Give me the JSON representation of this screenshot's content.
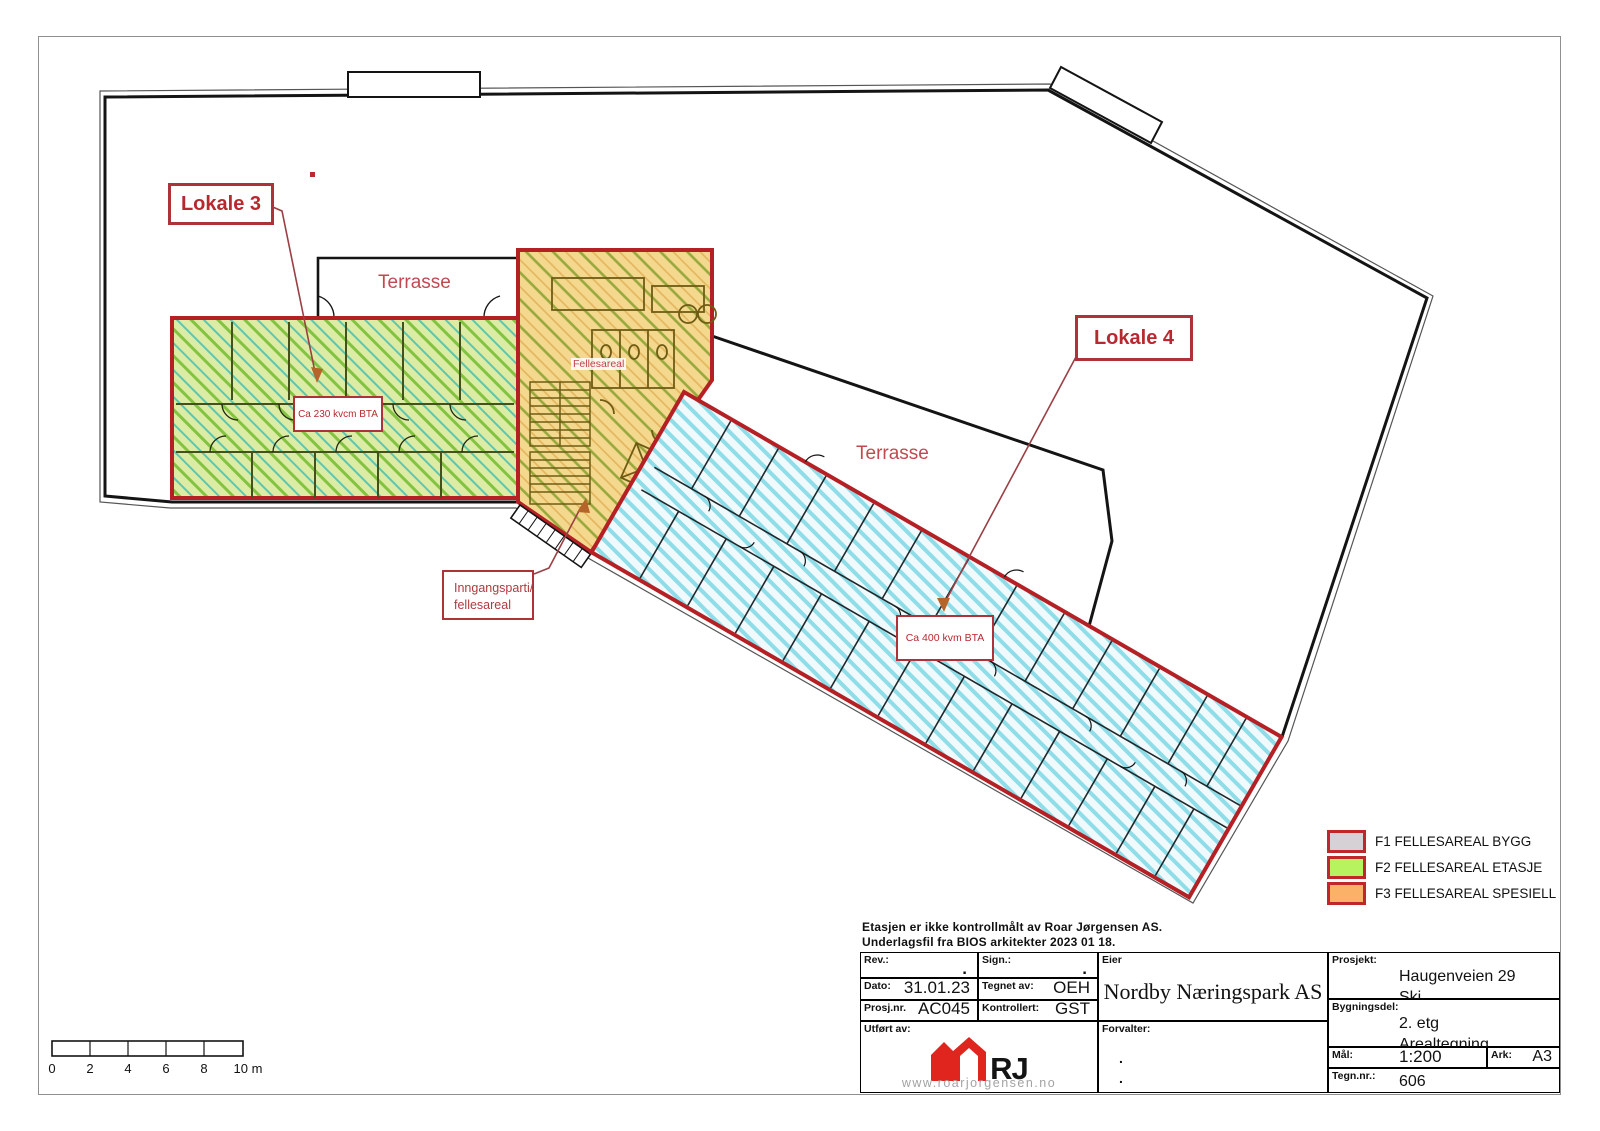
{
  "plan": {
    "lokale3": "Lokale 3",
    "lokale4": "Lokale 4",
    "terrasse_left": "Terrasse",
    "terrasse_right": "Terrasse",
    "fellesareal": "Fellesareal",
    "inngangsparti_line1": "Inngangsparti/",
    "inngangsparti_line2": "fellesareal",
    "area_lokale3": "Ca 230 kvcm BTA",
    "area_lokale4": "Ca 400 kvm BTA",
    "scalebar": {
      "ticks": [
        "0",
        "2",
        "4",
        "6",
        "8",
        "10 m"
      ]
    }
  },
  "legend": {
    "items": [
      {
        "code": "F1",
        "label": "F1 FELLESAREAL BYGG",
        "color": "#d5d1d5"
      },
      {
        "code": "F2",
        "label": "F2 FELLESAREAL ETASJE",
        "color": "#b7f25f"
      },
      {
        "code": "F3",
        "label": "F3 FELLESAREAL SPESIELL",
        "color": "#fbb168"
      }
    ]
  },
  "notes": {
    "line1": "Etasjen er ikke kontrollmålt av Roar Jørgensen AS.",
    "line2": "Underlagsfil fra BIOS arkitekter 2023 01 18."
  },
  "titleblock": {
    "rev": {
      "label": "Rev.:",
      "value": "."
    },
    "sign": {
      "label": "Sign.:",
      "value": "."
    },
    "dato": {
      "label": "Dato:",
      "value": "31.01.23"
    },
    "tegnet": {
      "label": "Tegnet av:",
      "value": "OEH"
    },
    "prosjnr": {
      "label": "Prosj.nr.",
      "value": "AC045"
    },
    "kontrollert": {
      "label": "Kontrollert:",
      "value": "GST"
    },
    "utfort": {
      "label": "Utført av:"
    },
    "logo": {
      "text": "RJ",
      "url": "www.roarjorgensen.no"
    },
    "eier": {
      "label": "Eier",
      "value": "Nordby Næringspark AS"
    },
    "forvalter": {
      "label": "Forvalter:",
      "dot1": ".",
      "dot2": "."
    },
    "prosjekt": {
      "label": "Prosjekt:",
      "line1": "Haugenveien 29",
      "line2": "Ski"
    },
    "bygningsdel": {
      "label": "Bygningsdel:",
      "line1": "2. etg",
      "line2": "Arealtegning"
    },
    "maal": {
      "label": "Mål:",
      "value": "1:200"
    },
    "ark": {
      "label": "Ark:",
      "value": "A3"
    },
    "tegnnr": {
      "label": "Tegn.nr.:",
      "value": "606"
    }
  },
  "colors": {
    "zone_border": "#b52025",
    "green_fill": "#dcecа4",
    "orange_fill": "#f4d88e",
    "cyan_stripe": "#8edde8",
    "annotation_red": "#b8292f"
  }
}
